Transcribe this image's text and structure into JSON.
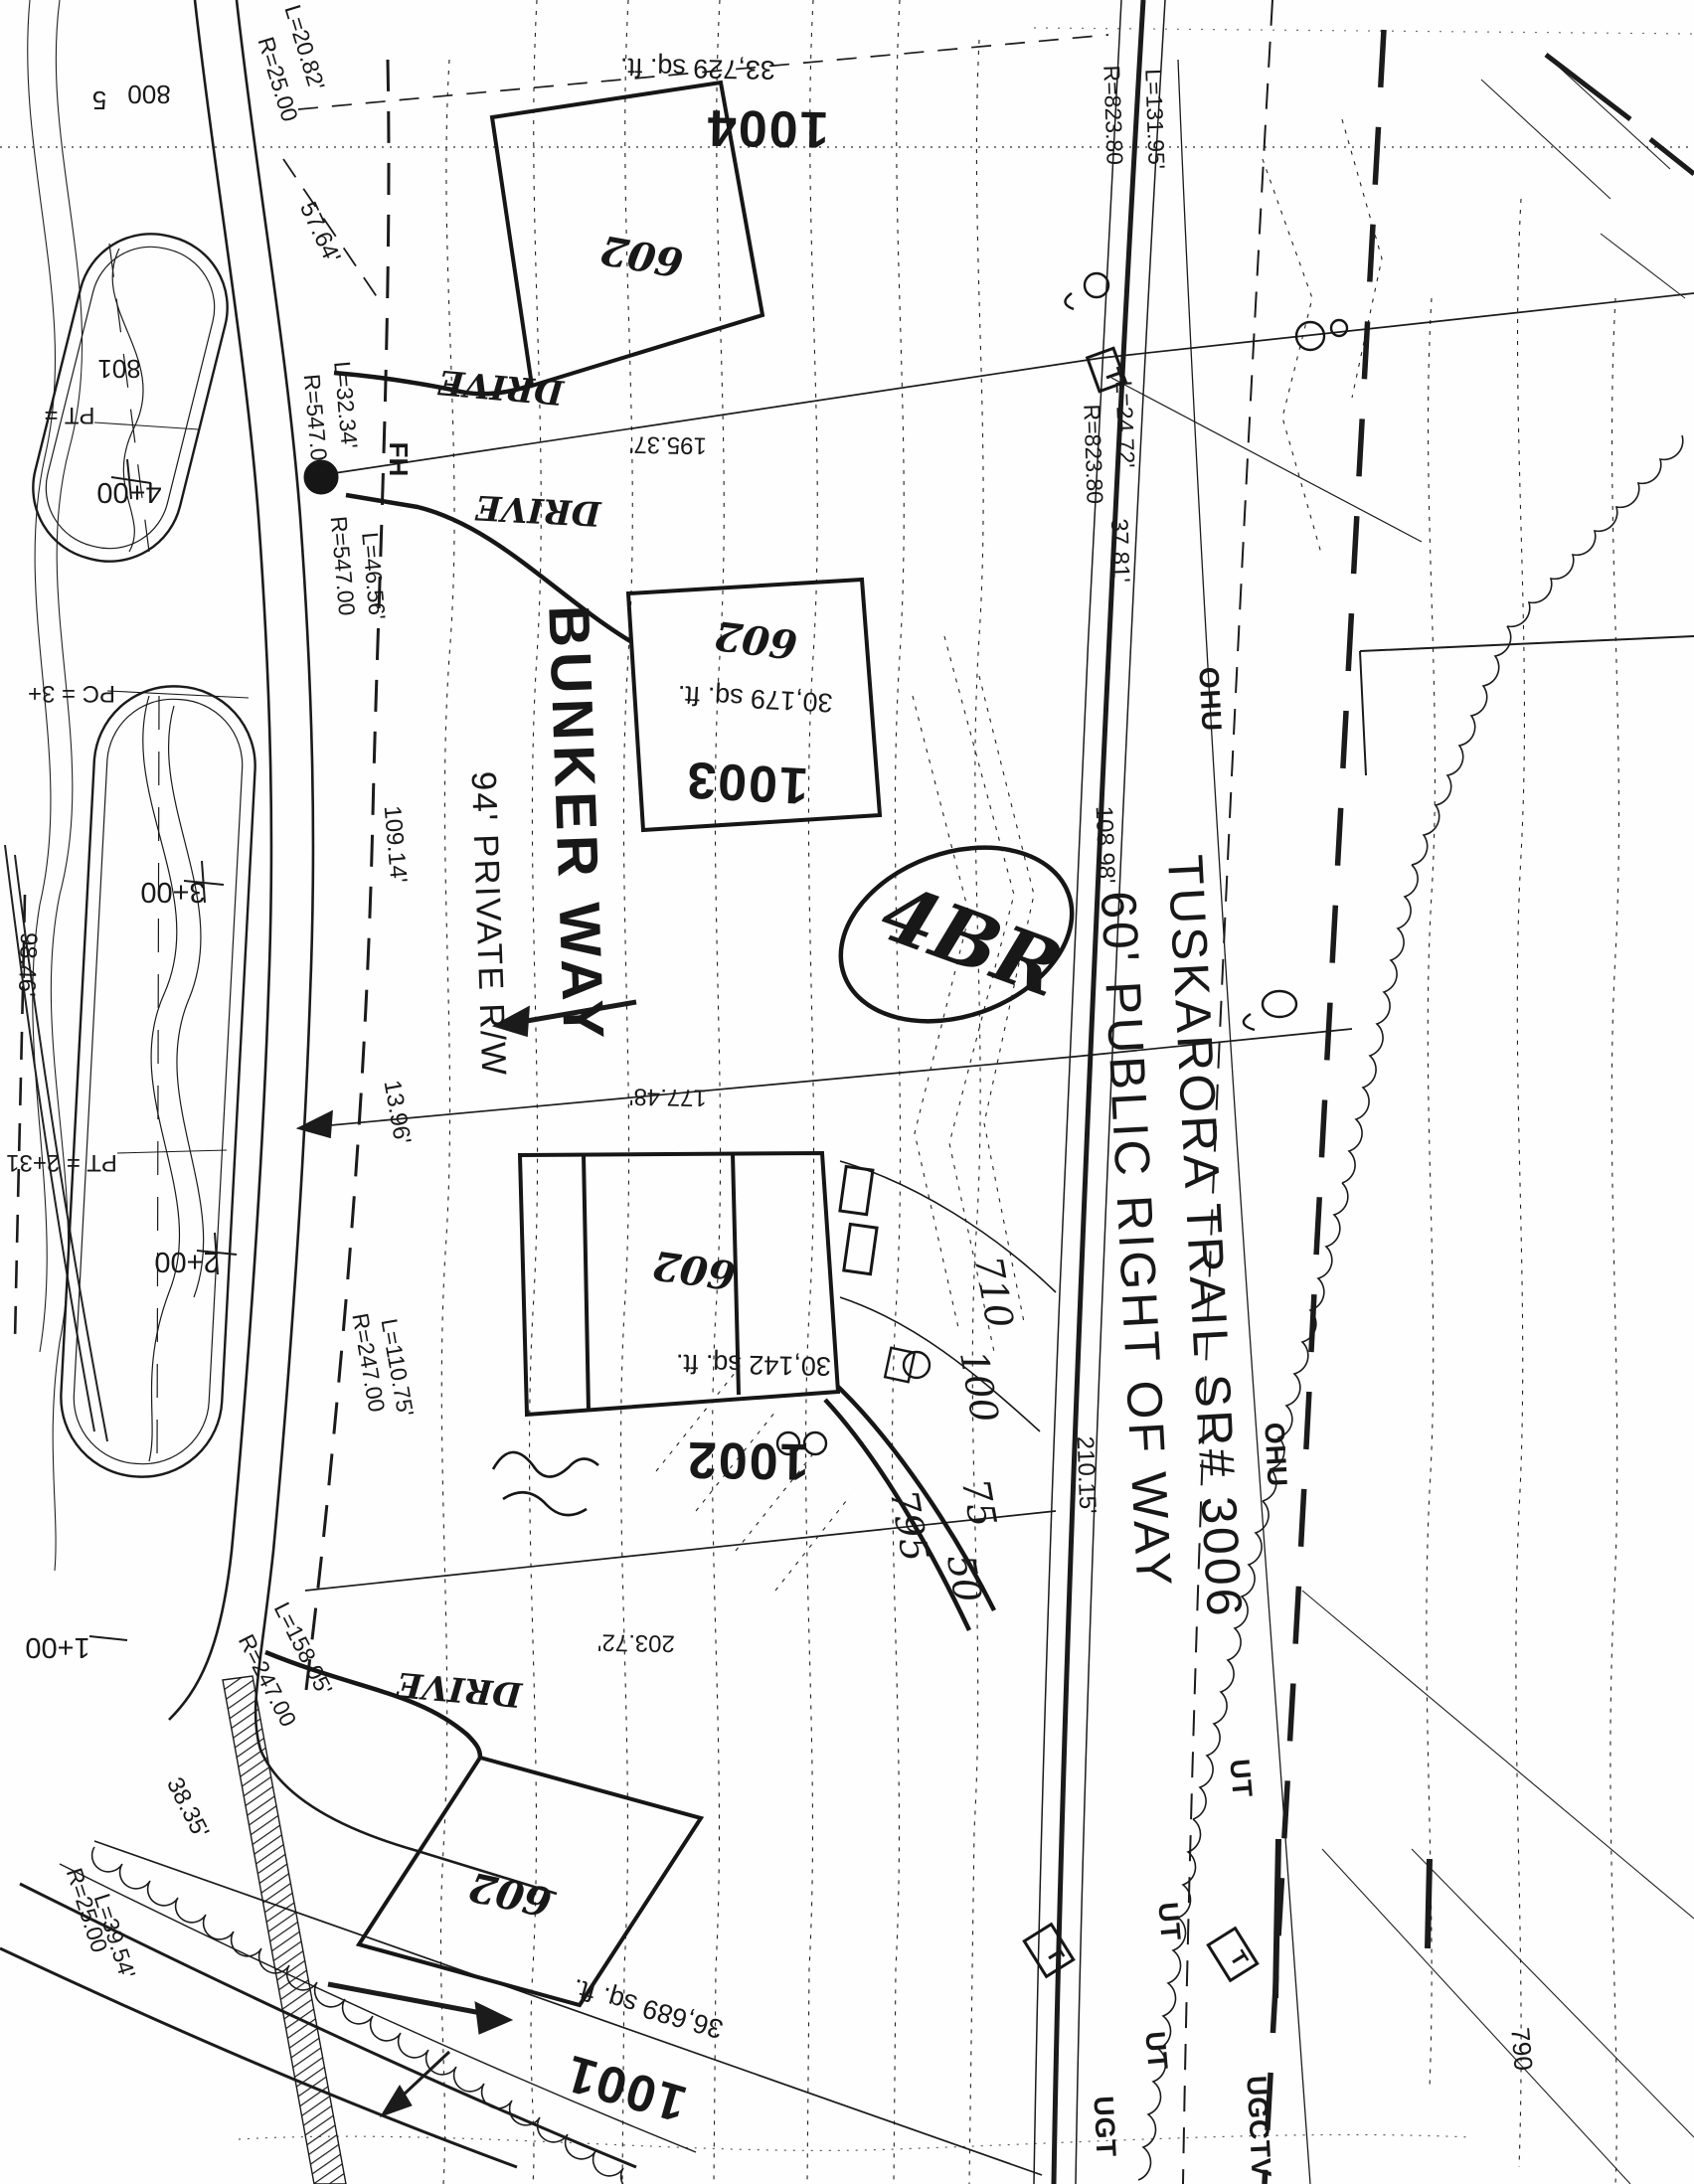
{
  "drawing": {
    "roads": {
      "bunker_name": "BUNKER WAY",
      "bunker_rw": "94' PRIVATE R/W",
      "tuskarora_name": "TUSKARORA TRAIL SR# 3006",
      "tuskarora_rw": "60' PUBLIC RIGHT OF WAY"
    },
    "lots": [
      {
        "id": "1004",
        "area": "33,729 sq. ft.",
        "house": "602"
      },
      {
        "id": "1003",
        "area": "30,179 sq. ft.",
        "house": "602"
      },
      {
        "id": "1002",
        "area": "30,142 sq. ft.",
        "house": "602"
      },
      {
        "id": "1001",
        "area": "36,689 sq. ft.",
        "house": "602"
      }
    ],
    "annotations": {
      "bedrooms": "4BR",
      "drive1": "DRIVE",
      "drive2": "DRIVE",
      "drive3": "DRIVE"
    },
    "stations": {
      "s4": "4+00",
      "s3": "3+00",
      "s2": "2+00",
      "s1": "1+00",
      "pt_upper": "PT =",
      "pc": "PC = 3+",
      "pt_lower": "PT = 2+31"
    },
    "curves": {
      "r25_top": "R=25.00",
      "l20": "L=20.82'",
      "r547_a": "R=547.00",
      "l32": "L=32.34'",
      "r547_b": "R=547.00",
      "l46": "L=46.56'",
      "r823_a": "R=823.80",
      "l131": "L=131.95'",
      "r823_b": "R=823.80",
      "l24": "L=24.72'",
      "r247_a": "R=247.00",
      "l110": "L=110.75'",
      "r247_b": "R=247.00",
      "l158": "L=158.05'",
      "r25_bot": "R=25.00",
      "l39": "L=39.54'"
    },
    "dims": {
      "d195": "195.37'",
      "d177": "177.48'",
      "d203": "203.72'",
      "d108": "108.98'",
      "d210": "210.15'",
      "d57": "57.64'",
      "d38": "38.35'",
      "d98": "98.46'",
      "d13": "13.96'",
      "d109": "109.14'",
      "d37": "37.81'"
    },
    "utilities": {
      "fh": "FH",
      "ohu_a": "OHU",
      "ohu_b": "OHU",
      "ut_a": "UT",
      "ut_b": "UT",
      "ut_c": "UT",
      "ugt": "UGT",
      "ugctv": "UGCTV",
      "t_a": "T",
      "t_b": "T",
      "t_c": "T"
    },
    "contours": {
      "c800": "800",
      "c801": "801",
      "c790": "790",
      "c795": "795",
      "c75": "75",
      "c50": "50",
      "c710": "710",
      "c100": "100",
      "c5": "5"
    }
  }
}
